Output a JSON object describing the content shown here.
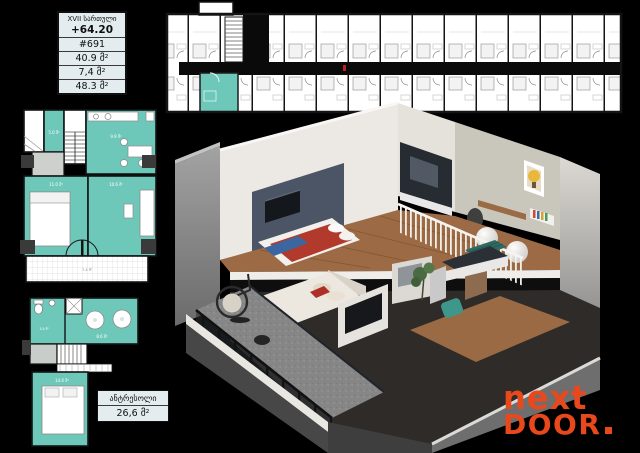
{
  "info_box": {
    "floor_label": "XVII სართული",
    "elevation": "+64.20",
    "unit_number": "#691",
    "area_internal": "40.9 მ²",
    "area_balcony": "7,4 მ²",
    "area_total": "48.3 მ²"
  },
  "mezzanine_box": {
    "title": "ანტრესოლი",
    "area": "26,6 მ²"
  },
  "logo": {
    "word1": "next",
    "word2": "DOOR",
    "color": "#e8481c"
  },
  "plan_labels": {
    "main": {
      "hall": "5.0 მ²",
      "kitchen": "9.9 მ²",
      "bedroom": "11.0 მ²",
      "living": "10.6 მ²",
      "balcony": "7.4 მ²"
    },
    "mezzanine": {
      "bathroom": "3.4 მ²",
      "room": "8.6 მ²",
      "bedroom": "14.6 მ²"
    }
  },
  "colors": {
    "highlight_teal": "#6ec8b9",
    "logo_orange": "#e8481c",
    "accent_wall": "#4b5565",
    "background": "#000000"
  }
}
